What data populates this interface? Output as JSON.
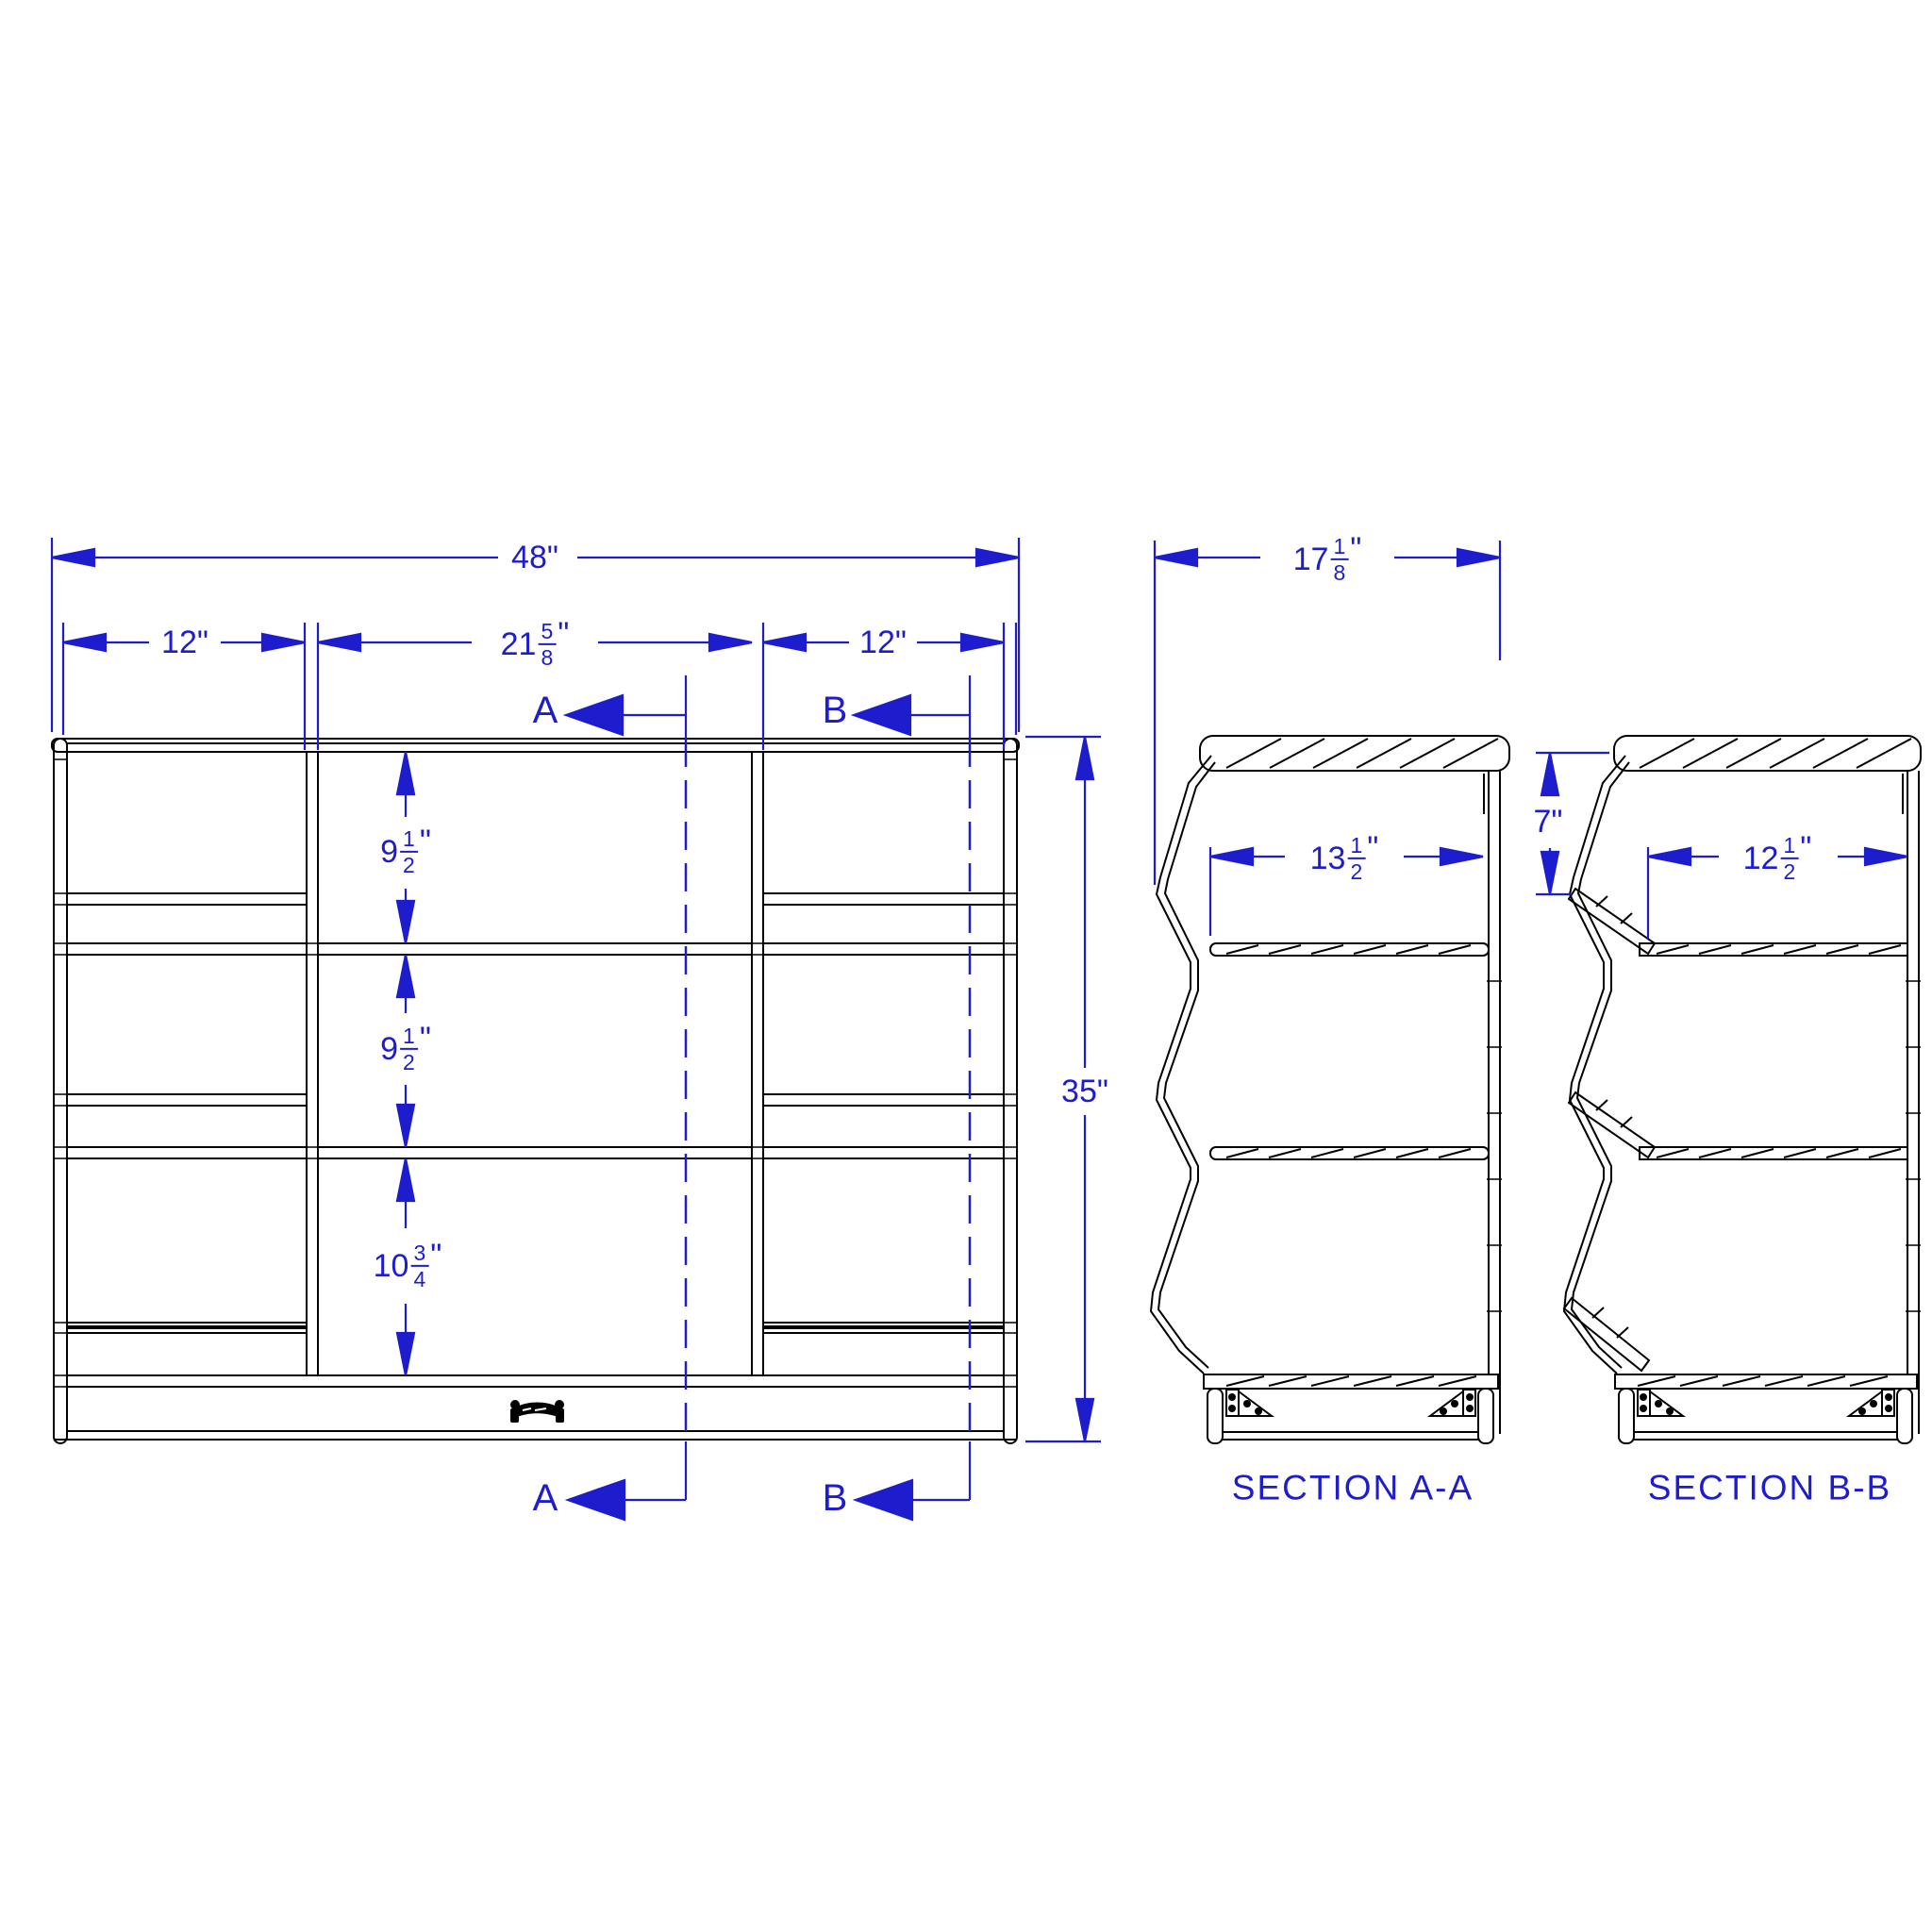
{
  "colors": {
    "dimension_blue": "#1d1dce",
    "geometry_black": "#000000",
    "background": "#ffffff"
  },
  "front_view": {
    "dims": {
      "overall_width": "48\"",
      "left_opening": "12\"",
      "middle_opening": {
        "whole": "21",
        "num": "5",
        "den": "8",
        "unit": "\""
      },
      "right_opening": "12\"",
      "overall_height": "35\"",
      "upper_shelf_spacing": {
        "whole": "9",
        "num": "1",
        "den": "2",
        "unit": "\""
      },
      "middle_shelf_spacing": {
        "whole": "9",
        "num": "1",
        "den": "2",
        "unit": "\""
      },
      "lower_shelf_spacing": {
        "whole": "10",
        "num": "3",
        "den": "4",
        "unit": "\""
      }
    },
    "section_cut_a": "A",
    "section_cut_b": "B"
  },
  "section_a": {
    "title": "SECTION A-A",
    "dims": {
      "overall_depth": {
        "whole": "17",
        "num": "1",
        "den": "8",
        "unit": "\""
      },
      "shelf_depth": {
        "whole": "13",
        "num": "1",
        "den": "2",
        "unit": "\""
      }
    }
  },
  "section_b": {
    "title": "SECTION B-B",
    "dims": {
      "front_drop": "7\"",
      "shelf_depth": {
        "whole": "12",
        "num": "1",
        "den": "2",
        "unit": "\""
      }
    }
  }
}
